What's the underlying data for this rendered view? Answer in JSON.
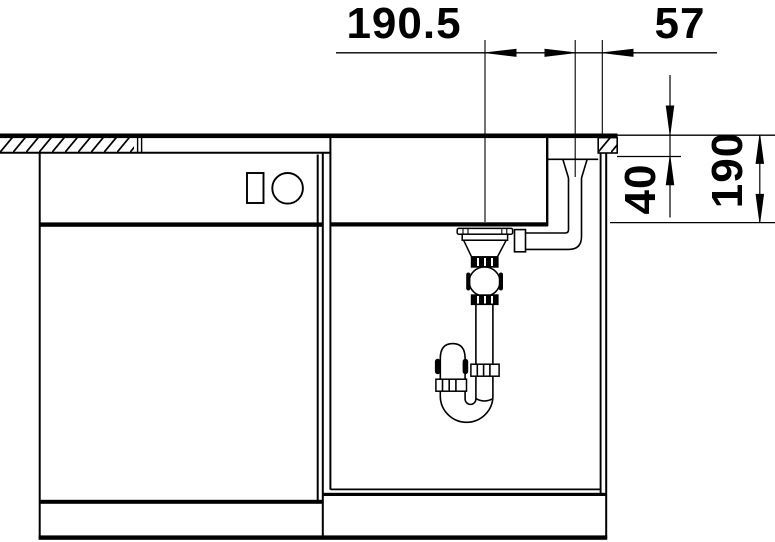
{
  "drawing": {
    "type": "technical-section",
    "subject": "kitchen sink installation cross-section with countertop, base cabinets, bowl, overflow pipe and siphon trap",
    "background_color": "#ffffff",
    "line_color": "#000000",
    "dimensions": [
      {
        "id": "drain-center-to-overflow-center",
        "value": "190.5",
        "orientation": "horizontal"
      },
      {
        "id": "overflow-center-to-cutout-edge",
        "value": "57",
        "orientation": "horizontal"
      },
      {
        "id": "countertop-thickness",
        "value": "40",
        "orientation": "vertical"
      },
      {
        "id": "bowl-depth",
        "value": "190",
        "orientation": "vertical"
      }
    ]
  }
}
